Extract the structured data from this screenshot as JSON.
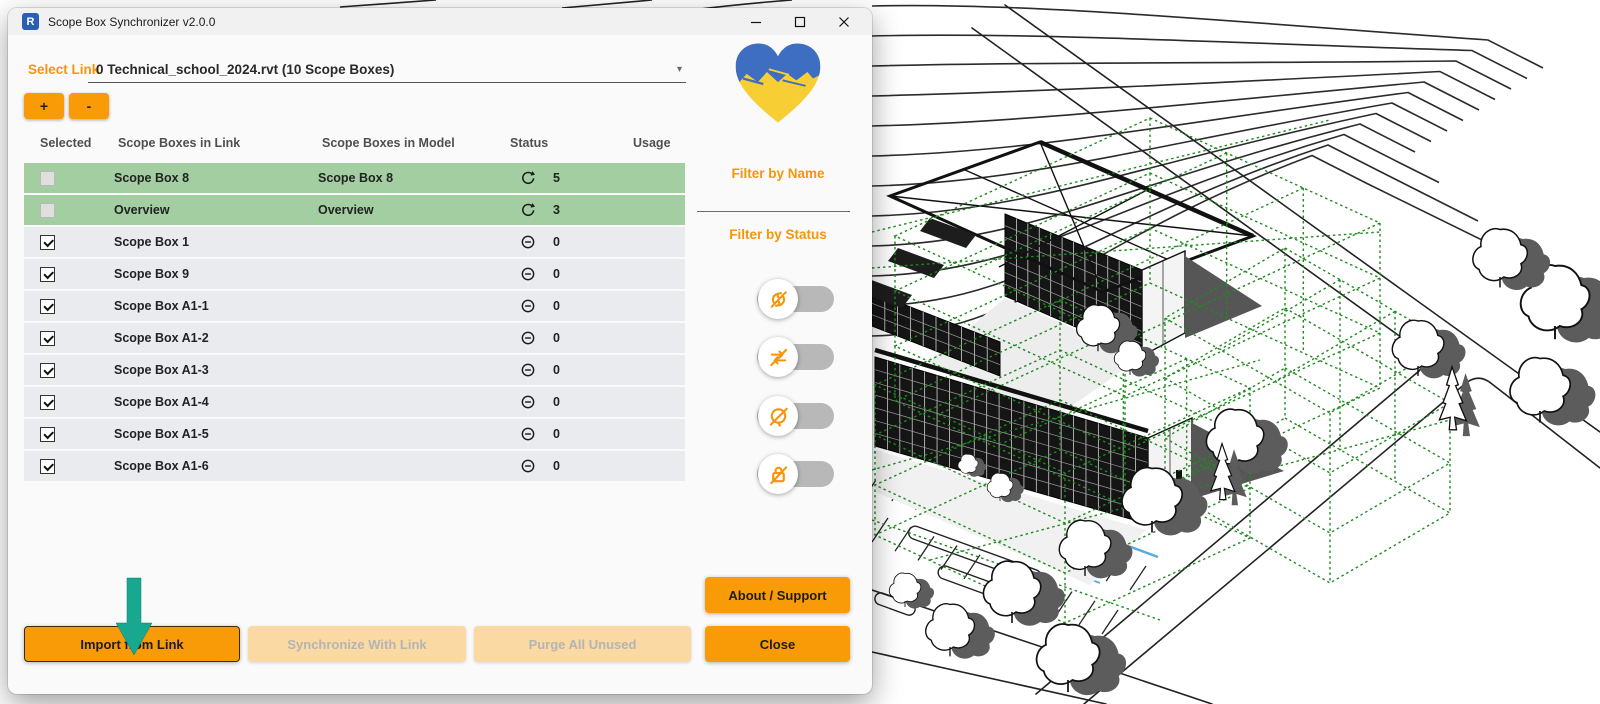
{
  "window": {
    "title": "Scope Box Synchronizer v2.0.0",
    "app_icon_letter": "R",
    "controls": [
      "minimize",
      "maximize",
      "close"
    ]
  },
  "link_selector": {
    "label": "Select Link",
    "value": "0 Technical_school_2024.rvt (10 Scope Boxes)",
    "add_label": "+",
    "remove_label": "-"
  },
  "table": {
    "columns": [
      "Selected",
      "Scope Boxes in Link",
      "Scope Boxes in Model",
      "Status",
      "Usage"
    ],
    "rows": [
      {
        "selected": false,
        "link_name": "Scope Box 8",
        "model_name": "Scope Box 8",
        "status": "synced",
        "usage": "5",
        "highlighted": true
      },
      {
        "selected": false,
        "link_name": "Overview",
        "model_name": "Overview",
        "status": "synced",
        "usage": "3",
        "highlighted": true
      },
      {
        "selected": true,
        "link_name": "Scope Box 1",
        "model_name": "",
        "status": "absent",
        "usage": "0",
        "highlighted": false
      },
      {
        "selected": true,
        "link_name": "Scope Box 9",
        "model_name": "",
        "status": "absent",
        "usage": "0",
        "highlighted": false
      },
      {
        "selected": true,
        "link_name": "Scope Box A1-1",
        "model_name": "",
        "status": "absent",
        "usage": "0",
        "highlighted": false
      },
      {
        "selected": true,
        "link_name": "Scope Box A1-2",
        "model_name": "",
        "status": "absent",
        "usage": "0",
        "highlighted": false
      },
      {
        "selected": true,
        "link_name": "Scope Box A1-3",
        "model_name": "",
        "status": "absent",
        "usage": "0",
        "highlighted": false
      },
      {
        "selected": true,
        "link_name": "Scope Box A1-4",
        "model_name": "",
        "status": "absent",
        "usage": "0",
        "highlighted": false
      },
      {
        "selected": true,
        "link_name": "Scope Box A1-5",
        "model_name": "",
        "status": "absent",
        "usage": "0",
        "highlighted": false
      },
      {
        "selected": true,
        "link_name": "Scope Box A1-6",
        "model_name": "",
        "status": "absent",
        "usage": "0",
        "highlighted": false
      }
    ],
    "status_icons": {
      "synced": "sync-icon",
      "absent": "circle-minus-icon"
    }
  },
  "side_panel": {
    "logo": "ukraine-heart-logo",
    "filter_by_name_label": "Filter by Name",
    "filter_by_status_label": "Filter by Status",
    "status_toggles": [
      {
        "icon": "sync-off-icon",
        "on": false
      },
      {
        "icon": "swap-arrows-off-icon",
        "on": false
      },
      {
        "icon": "block-off-icon",
        "on": false
      },
      {
        "icon": "lock-off-icon",
        "on": false
      }
    ]
  },
  "actions": {
    "import": "Import from Link",
    "synchronize": "Synchronize With Link",
    "purge": "Purge All Unused",
    "about": "About / Support",
    "close": "Close"
  },
  "colors": {
    "accent": "#F99B06",
    "accent_disabled": "#FAD9A2",
    "matched_row": "#A3CEA1",
    "default_row": "#E9EBEE",
    "pointer_arrow": "#18A78F",
    "scope_box_green": "#1F8A1F",
    "flag_blue": "#3D6EC2",
    "flag_yellow": "#F8CE35"
  }
}
